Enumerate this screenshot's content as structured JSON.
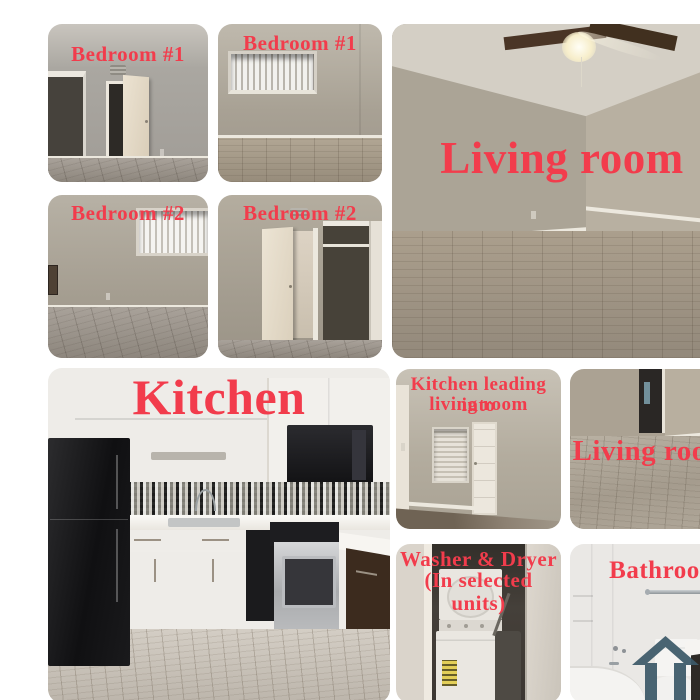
{
  "collage": {
    "background": "#ffffff",
    "label_color": "#f23c4c"
  },
  "photos": {
    "bedroom1_a": {
      "label": "Bedroom #1"
    },
    "bedroom1_b": {
      "label": "Bedroom #1"
    },
    "living_room_main": {
      "label": "Living room"
    },
    "bedroom2_a": {
      "label": "Bedroom #2"
    },
    "bedroom2_b": {
      "label": "Bedroom #2"
    },
    "kitchen": {
      "label": "Kitchen"
    },
    "kitchen_leading": {
      "label_line1": "Kitchen leading into",
      "label_line2": "living room"
    },
    "living_room_small": {
      "label": "Living room"
    },
    "washer_dryer": {
      "label_line1": "Washer & Dryer",
      "label_line2": "(In selected units)"
    },
    "bathroom": {
      "label": "Bathroom"
    }
  },
  "watermark": {
    "icon": "house-icon",
    "color": "#3d5a69"
  }
}
